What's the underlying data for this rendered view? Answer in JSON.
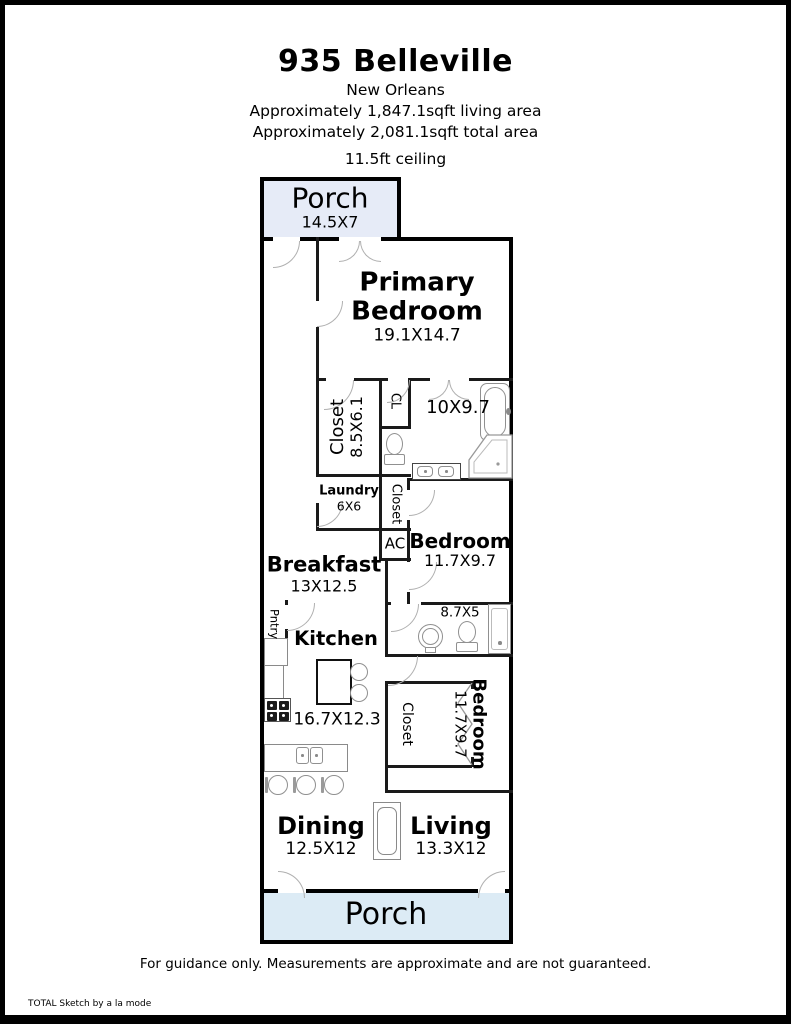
{
  "header": {
    "title": "935 Belleville",
    "subtitle": "New Orleans",
    "living_area": "Approximately 1,847.1sqft living area",
    "total_area": "Approximately 2,081.1sqft total area",
    "ceiling": "11.5ft ceiling"
  },
  "footer": {
    "disclaimer": "For guidance only. Measurements are approximate and are not guaranteed.",
    "credit": "TOTAL Sketch by a la mode"
  },
  "plan": {
    "rooms": {
      "porch_top": {
        "name": "Porch",
        "dims": "14.5X7"
      },
      "primary_bedroom": {
        "name": "Primary Bedroom",
        "dims": "19.1X14.7"
      },
      "primary_closet": {
        "name": "Closet",
        "dims": "8.5X6.1"
      },
      "cl": {
        "name": "CL"
      },
      "primary_bath": {
        "dims": "10X9.7"
      },
      "laundry": {
        "name": "Laundry",
        "dims": "6X6"
      },
      "bedroom2_closet": {
        "name": "Closet"
      },
      "ac": {
        "name": "AC"
      },
      "bedroom2": {
        "name": "Bedroom",
        "dims": "11.7X9.7"
      },
      "breakfast": {
        "name": "Breakfast",
        "dims": "13X12.5"
      },
      "bath2": {
        "dims": "8.7X5"
      },
      "pantry": {
        "name": "Pntry"
      },
      "kitchen": {
        "name": "Kitchen",
        "dims": "16.7X12.3"
      },
      "bedroom3_closet": {
        "name": "Closet"
      },
      "bedroom3": {
        "name": "Bedroom",
        "dims": "11.7X9.7"
      },
      "dining": {
        "name": "Dining",
        "dims": "12.5X12"
      },
      "living": {
        "name": "Living",
        "dims": "13.3X12"
      },
      "porch_bottom": {
        "name": "Porch"
      }
    },
    "colors": {
      "outer_wall": "#000000",
      "interior_wall": "#1a1a1a",
      "porch_top_fill": "#e6ebf7",
      "porch_bottom_fill": "#dcebf5",
      "door_arc": "#b0b0b0",
      "fixture_line": "#909090"
    }
  }
}
